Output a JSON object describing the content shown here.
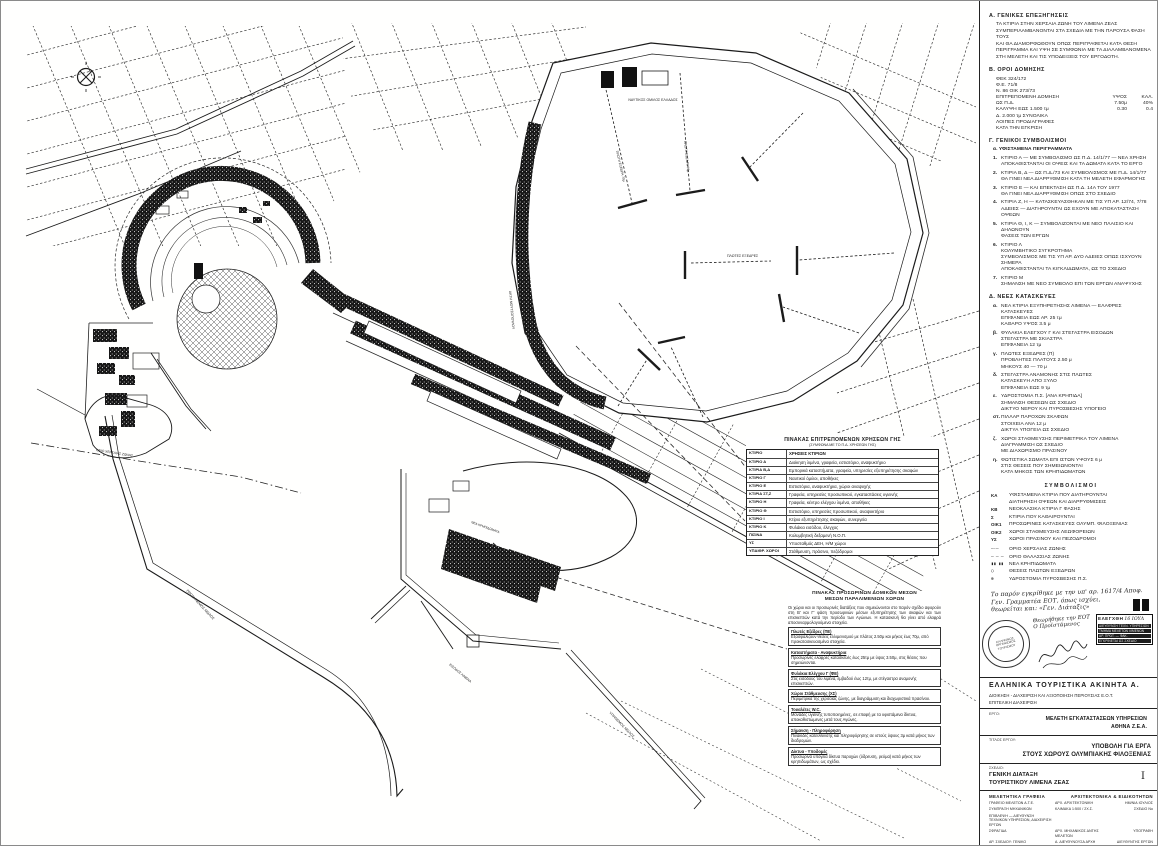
{
  "ink": "#1b1b1b",
  "map": {
    "labels": [
      {
        "text": "ΝΑΥΤΙΚΟΣ ΟΜΙΛΟΣ ΕΛΛΑΔΟΣ"
      },
      {
        "text": "ΠΛΩΤΗ ΕΞΕΔΡΑ 70μ"
      },
      {
        "text": "ΠΛΩΤΗ ΕΞΕΔΡΑ 70μ"
      },
      {
        "text": "ΠΛΩΤΕΣ ΕΞΕΔΡΕΣ"
      },
      {
        "text": "ΑΚΤΗ ΜΟΥΤΣΟΠΟΥΛΟΥ"
      },
      {
        "text": "ΝΕΑ ΚΡΗΠΙΔΩΜΑΤΑ"
      },
      {
        "text": "ΠΡΟΣΗΝΕΜΟΣ ΜΩΛΟΣ"
      },
      {
        "text": "ΥΠΗΝΕΜΟΣ ΜΩΛΟΣ"
      },
      {
        "text": "ΟΡΙΟ ΧΕΡΣΑΙΑΣ ΖΩΝΗΣ"
      },
      {
        "text": "ΕΙΣΟΔΟΣ ΛΙΜΕΝΑ"
      }
    ],
    "tables": {
      "landuse": {
        "title": "ΠΙΝΑΚΑΣ ΕΠΙΤΡΕΠΟΜΕΝΩΝ ΧΡΗΣΕΩΝ ΓΗΣ",
        "subtitle": "(ΣΥΜΦΩΝΑ ΜΕ ΤΟ Π.Δ. ΧΡΗΣΕΩΝ ΓΗΣ)",
        "col1": "ΚΤΙΡΙΟ",
        "col2": "ΧΡΗΣΕΙΣ ΚΤΙΡΙΩΝ",
        "rows": [
          {
            "code": "ΚΤΙΡΙΟ Α",
            "use": "Διοίκηση λιμένα, γραφεία, εστιατόριο, αναψυκτήριο"
          },
          {
            "code": "ΚΤΙΡΙΑ Β,Δ",
            "use": "Εμπορικά καταστήματα, γραφεία, υπηρεσίες εξυπηρέτησης σκαφών"
          },
          {
            "code": "ΚΤΙΡΙΟ Γ",
            "use": "Ναυτικοί όμιλοι, αποθήκες"
          },
          {
            "code": "ΚΤΙΡΙΟ Ε",
            "use": "Εστιατόρια, αναψυκτήρια, χώροι αναψυχής"
          },
          {
            "code": "ΚΤΙΡΙΑ ΣΤ,Ζ",
            "use": "Γραφεία, υπηρεσίες προσωπικού, εγκαταστάσεις υγιεινής"
          },
          {
            "code": "ΚΤΙΡΙΟ Η",
            "use": "Γραφεία, κέντρο ελέγχου λιμένα, αποθήκες"
          },
          {
            "code": "ΚΤΙΡΙΟ Θ",
            "use": "Εστιατόριο, υπηρεσίες προσωπικού, αναψυκτήριο"
          },
          {
            "code": "ΚΤΙΡΙΟ Ι",
            "use": "Κτίριο εξυπηρέτησης σκαφών, συνεργεία"
          },
          {
            "code": "ΚΤΙΡΙΟ Κ",
            "use": "Φυλάκιο εισόδου, έλεγχος"
          },
          {
            "code": "ΠΙΣΙΝΑ",
            "use": "Κολυμβητική δεξαμενή Ν.Ο.Π."
          },
          {
            "code": "ΥΣ",
            "use": "Υποσταθμός ΔΕΗ, Η/Μ χώροι"
          },
          {
            "code": "ΥΠΑΙΘΡ. ΧΩΡΟΙ",
            "use": "Στάθμευση, πράσινο, πεζόδρομοι"
          }
        ]
      },
      "temp": {
        "title1": "ΠΙΝΑΚΑΣ ΠΡΟΣΩΡΙΝΩΝ ΔΟΜΙΚΩΝ ΜΕΣΩΝ",
        "title2": "ΜΕΣΩΝ ΠΑΡΑΛΙΜΕΝΙΩΝ ΧΩΡΩΝ",
        "intro": "Οι χώροι και οι προσωρινές διατάξεις που σημειώνονται στο παρόν σχέδιο αφορούν στη Β' και Γ' φάση προσωρινών μέσων εξυπηρέτησης των σκαφών και των επισκεπτών κατά την περίοδο των Αγώνων. Η κατασκευή θα γίνει από ελαφρά αποσυναρμολογούμενα στοιχεία.",
        "sections": [
          {
            "h": "Πλωτές Εξέδρες (ΠΕ)",
            "b": "Εξασφαλίζουν θέσεις ελλιμενισμού με πλάτος 2.50μ και μήκος έως 70μ, από προκατασκευασμένα στοιχεία."
          },
          {
            "h": "Καταστήματα - Αναψυκτήρια",
            "b": "Προσωρινές ελαφρές κατασκευές έως 25τμ με ύψος 3.50μ, στις θέσεις που σημειώνονται."
          },
          {
            "h": "Φυλάκια Ελέγχου Γ (ΦΕ)",
            "b": "Στις εισόδους του λιμένα, εμβαδού έως 12τμ, με στέγαστρα αναμονής επισκεπτών."
          },
          {
            "h": "Χώροι Στάθμευσης (ΧΣ)",
            "b": "Περιμετρικά της χερσαίας ζώνης, με διαγράμμιση και διαχωριστικά πρασίνου."
          },
          {
            "h": "Τουαλέτες W.C.",
            "b": "Μονάδες υγιεινής τυποποιημένες, σε επαφή με τα υφιστάμενα δίκτυα, αποκαθιστώμενες μετά τους Αγώνες."
          },
          {
            "h": "Σήμανση - Πληροφόρηση",
            "b": "Πινακίδες κατεύθυνσης και πληροφόρησης σε ιστούς ύψους 3μ κατά μήκος των διαδρομών."
          },
          {
            "h": "Δίκτυα - Υποδομές",
            "b": "Προσωρινά υπόγεια δίκτυα παροχών (ύδρευση, ρεύμα) κατά μήκος των κρηπιδωμάτων, ως σχέδιο."
          }
        ]
      }
    }
  },
  "sidebar": {
    "secA": {
      "heading": "Α. ΓΕΝΙΚΕΣ ΕΠΕΞΗΓΗΣΕΙΣ",
      "lines": [
        "ΤΑ ΚΤΙΡΙΑ ΣΤΗΝ ΧΕΡΣΑΙΑ ΖΩΝΗ ΤΟΥ ΛΙΜΕΝΑ ΖΕΑΣ",
        "ΣΥΜΠΕΡΙΛΑΜΒΑΝΟΝΤΑΙ ΣΤΑ ΣΧΕΔΙΑ ΜΕ ΤΗΝ ΠΑΡΟΥΣΑ ΦΑΣΗ ΤΟΥΣ",
        "ΚΑΙ ΘΑ ΔΙΑΜΟΡΦΩΘΟΥΝ ΟΠΩΣ ΠΕΡΙΓΡΑΦΕΤΑΙ ΚΑΤΑ ΘΕΣΗ",
        "ΠΕΡΙΓΡΑΜΜΑ ΚΑΙ ΥΨΗ ΣΕ ΣΥΜΦΩΝΙΑ ΜΕ ΤΑ ΔΙΑΛΑΜΒΑΝΟΜΕΝΑ",
        "ΣΤΗ ΜΕΛΕΤΗ ΚΑΙ ΤΙΣ ΥΠΟΔΕΙΞΕΙΣ ΤΟΥ ΕΡΓΟΔΟΤΗ."
      ]
    },
    "secB": {
      "heading": "Β. ΟΡΟΙ ΔΟΜΗΣΗΣ",
      "rows": [
        {
          "l": "ΦΕΚ 324/172",
          "c1": "",
          "c2": ""
        },
        {
          "l": "Φ.Ε. 71/8",
          "c1": "",
          "c2": ""
        },
        {
          "l": "Ν. 86 ΟΙΚ 273/73",
          "c1": "",
          "c2": ""
        },
        {
          "l": "ΕΠΙΤΡΕΠΟΜΕΝΗ ΔΟΜΗΣΗ",
          "c1": "ΥΨΟΣ",
          "c2": "ΚΑΛ."
        },
        {
          "l": "ΩΣ Π.Δ.",
          "c1": "7.50μ",
          "c2": "40%"
        },
        {
          "l": "ΚΑΛΥΨΗ ΕΩΣ 1.500 τμ",
          "c1": "0.30",
          "c2": "0.4"
        },
        {
          "l": "Δ. 2.000 τμ ΣΥΝΟΛΙΚΑ",
          "c1": "",
          "c2": ""
        },
        {
          "l": "ΛΟΙΠΕΣ ΠΡΟΔΙΑΓΡΑΦΕΣ",
          "c1": "",
          "c2": ""
        },
        {
          "l": "ΚΑΤΑ ΤΗΝ ΕΓΚΡΙΣΗ",
          "c1": "",
          "c2": ""
        }
      ]
    },
    "secC": {
      "heading": "Γ. ΓΕΝΙΚΟΙ ΣΥΜΒΟΛΙΣΜΟΙ",
      "sub": "α. ΥΦΙΣΤΑΜΕΝΑ ΠΕΡΙΓΡΑΜΜΑΤΑ",
      "items": [
        {
          "n": "1.",
          "l1": "ΚΤΙΡΙΟ Α — ΜΕ ΣΥΜΒΟΛΙΣΜΟ ΩΣ Π.Δ. 14/1/77 — ΝΕΑ ΧΡΗΣΗ",
          "l2": "ΑΠΟΚΑΘΙΣΤΑΝΤΑΙ ΟΙ ΟΨΕΙΣ ΚΑΙ ΤΑ ΔΩΜΑΤΑ ΚΑΤΑ ΤΟ ΕΡΓΟ",
          "l3": "",
          "l4": ""
        },
        {
          "n": "2.",
          "l1": "ΚΤΙΡΙΑ Β, Δ — ΩΣ Π.Δ./73 ΚΑΙ ΣΥΜΒΟΛΙΣΜΟΣ ΜΕ Π.Δ. 14/1/77",
          "l2": "ΘΑ ΓΙΝΕΙ ΝΕΑ ΔΙΑΡΡΥΘΜΙΣΗ ΚΑΤΑ ΤΗ ΜΕΛΕΤΗ ΕΦΑΡΜΟΓΗΣ",
          "l3": "",
          "l4": ""
        },
        {
          "n": "3.",
          "l1": "ΚΤΙΡΙΟ Ε — ΚΑΙ ΕΠΕΚΤΑΣΗ ΩΣ Π.Δ. 14Α ΤΟΥ 1977",
          "l2": "ΘΑ ΓΙΝΕΙ ΝΕΑ ΔΙΑΡΡΥΘΜΙΣΗ ΟΠΩΣ ΣΤΟ ΣΧΕΔΙΟ",
          "l3": "",
          "l4": ""
        },
        {
          "n": "4.",
          "l1": "ΚΤΙΡΙΑ Ζ, Η — ΚΑΤΑΣΚΕΥΑΣΘΗΚΑΝ ΜΕ ΤΙΣ ΥΠ ΑΡ. 12/74, 7/78",
          "l2": "ΑΔΕΙΕΣ — ΔΙΑΤΗΡΟΥΝΤΑΙ ΩΣ ΕΧΟΥΝ ΜΕ ΑΠΟΚΑΤΑΣΤΑΣΗ ΟΨΕΩΝ",
          "l3": "",
          "l4": ""
        },
        {
          "n": "5.",
          "l1": "ΚΤΙΡΙΑ Θ, Ι, Κ — ΣΥΜΒΟΛΙΖΟΝΤΑΙ ΜΕ ΝΕΟ ΠΛΑΙΣΙΟ ΚΑΙ ΔΗΛΩΝΟΥΝ",
          "l2": "ΦΑΣΕΙΣ ΤΩΝ ΕΡΓΩΝ",
          "l3": "",
          "l4": ""
        },
        {
          "n": "6.",
          "l1": "ΚΤΙΡΙΟ Λ",
          "l2": "ΚΟΛΥΜΒΗΤΙΚΟ ΣΥΓΚΡΟΤΗΜΑ",
          "l3": "ΣΥΜΒΟΛΙΣΜΟΣ ΜΕ ΤΙΣ ΥΠ ΑΡ. ΔΥΟ ΑΔΕΙΕΣ ΟΠΩΣ ΙΣΧΥΟΥΝ ΣΗΜΕΡΑ",
          "l4": "ΑΠΟΚΑΘΙΣΤΑΝΤΑΙ ΤΑ ΚΙΓΚΛΙΔΩΜΑΤΑ, ΩΣ ΤΟ ΣΧΕΔΙΟ"
        },
        {
          "n": "7.",
          "l1": "ΚΤΙΡΙΟ Μ",
          "l2": "ΣΗΜΑΝΣΗ ΜΕ ΝΕΟ ΣΥΜΒΟΛΟ ΕΠΙ ΤΩΝ ΕΡΓΩΝ ΑΝΑΨΥΧΗΣ",
          "l3": "",
          "l4": ""
        }
      ]
    },
    "secD": {
      "heading": "Δ. ΝΕΕΣ ΚΑΤΑΣΚΕΥΕΣ",
      "items": [
        {
          "n": "α.",
          "l1": "ΝΕΑ ΚΤΙΡΙΑ ΕΞΥΠΗΡΕΤΗΣΗΣ ΛΙΜΕΝΑ — ΕΛΑΦΡΕΣ ΚΑΤΑΣΚΕΥΕΣ",
          "l2": "ΕΠΙΦΑΝΕΙΑ ΕΩΣ ΑΡ. 25 τμ",
          "l3": "ΚΑΘΑΡΟ ΥΨΟΣ 3.5 μ"
        },
        {
          "n": "β.",
          "l1": "ΦΥΛΑΚΙΑ ΕΛΕΓΧΟΥ Γ ΚΑΙ ΣΤΕΓΑΣΤΡΑ ΕΙΣΟΔΩΝ",
          "l2": "ΣΤΕΓΑΣΤΡΑ ΜΕ ΣΚΙΑΣΤΡΑ",
          "l3": "ΕΠΙΦΑΝΕΙΑ 12 τμ"
        },
        {
          "n": "γ.",
          "l1": "ΠΛΩΤΕΣ ΕΞΕΔΡΕΣ (Π)",
          "l2": "ΠΡΟΒΛΗΤΕΣ ΠΛΑΤΟΥΣ 2.50 μ",
          "l3": "ΜΗΚΟΥΣ 40 — 70 μ"
        },
        {
          "n": "δ.",
          "l1": "ΣΤΕΓΑΣΤΡΑ ΑΝΑΜΟΝΗΣ ΣΤΙΣ ΠΛΩΤΕΣ",
          "l2": "ΚΑΤΑΣΚΕΥΗ ΑΠΟ ΞΥΛΟ",
          "l3": "ΕΠΙΦΑΝΕΙΑ ΕΩΣ 9 τμ"
        },
        {
          "n": "ε.",
          "l1": "ΥΔΡΟΣΤΟΜΙΑ Π.Σ. [ΑΝΑ ΚΡΗΠΙΔΑ]",
          "l2": "ΣΗΜΑΝΣΗ ΘΕΣΕΩΝ ΩΣ ΣΧΕΔΙΟ",
          "l3": "ΔΙΚΤΥΟ ΝΕΡΟΥ ΚΑΙ ΠΥΡΟΣΒΕΣΗΣ ΥΠΟΓΕΙΟ"
        },
        {
          "n": "στ.",
          "l1": "ΠΙΛΛΑΡ ΠΑΡΟΧΩΝ ΣΚΑΦΩΝ",
          "l2": "ΣΤΟΙΧΕΙΑ ΑΝΑ 12 μ",
          "l3": "ΔΙΚΤΥΑ ΥΠΟΓΕΙΑ ΩΣ ΣΧΕΔΙΟ"
        },
        {
          "n": "ζ.",
          "l1": "ΧΩΡΟΙ ΣΤΑΘΜΕΥΣΗΣ ΠΕΡΙΜΕΤΡΙΚΑ ΤΟΥ ΛΙΜΕΝΑ",
          "l2": "ΔΙΑΓΡΑΜΜΙΣΗ ΩΣ ΣΧΕΔΙΟ",
          "l3": "ΜΕ ΔΙΑΧΩΡΙΣΜΟ ΠΡΑΣΙΝΟΥ"
        },
        {
          "n": "η.",
          "l1": "ΦΩΤΙΣΤΙΚΑ ΣΩΜΑΤΑ ΕΠΙ ΙΣΤΩΝ ΥΨΟΥΣ 6 μ",
          "l2": "ΣΤΙΣ ΘΕΣΕΙΣ ΠΟΥ ΣΗΜΕΙΩΝΟΝΤΑΙ",
          "l3": "ΚΑΤΑ ΜΗΚΟΣ ΤΩΝ ΚΡΗΠΙΔΩΜΑΤΩΝ"
        }
      ]
    },
    "legend": {
      "heading": "ΣΥΜΒΟΛΙΣΜΟΙ",
      "codes": [
        {
          "sym": "ΚΑ",
          "text": "ΥΦΙΣΤΑΜΕΝΑ ΚΤΙΡΙΑ ΠΟΥ ΔΙΑΤΗΡΟΥΝΤΑΙ"
        },
        {
          "sym": "",
          "text": "ΔΙΑΤΗΡΗΣΗ ΟΨΕΩΝ ΚΑΙ ΔΙΑΡΡΥΘΜΙΣΕΙΣ"
        },
        {
          "sym": "ΚΒ",
          "text": "ΝΕΟΚΛΑΣΙΚΑ ΚΤΙΡΙΑ Γ ΦΑΣΗΣ"
        },
        {
          "sym": "Σ",
          "text": "ΚΤΙΡΙΑ ΠΟΥ ΚΑΘΑΙΡΟΥΝΤΑΙ"
        },
        {
          "sym": "ΟΙΚ1",
          "text": "ΠΡΟΣΩΡΙΝΕΣ ΚΑΤΑΣΚΕΥΕΣ ΟΛΥΜΠ. ΦΙΛΟΞΕΝΙΑΣ"
        },
        {
          "sym": "ΟΙΚ2",
          "text": "ΧΩΡΟΙ ΣΤΑΘΜΕΥΣΗΣ ΛΕΩΦΟΡΕΙΩΝ"
        },
        {
          "sym": "ΥΣ",
          "text": "ΧΩΡΟΙ ΠΡΑΣΙΝΟΥ ΚΑΙ ΠΕΖΟΔΡΟΜΟΙ"
        }
      ],
      "lines": [
        {
          "sym": "—·—",
          "text": "ΟΡΙΟ ΧΕΡΣΑΙΑΣ ΖΩΝΗΣ"
        },
        {
          "sym": "– – –",
          "text": "ΟΡΙΟ ΘΑΛΑΣΣΙΑΣ ΖΩΝΗΣ"
        },
        {
          "sym": "▮▮ ▮▮",
          "text": "ΝΕΑ ΚΡΗΠΙΔΩΜΑΤΑ"
        },
        {
          "sym": "○",
          "text": "ΘΕΣΕΙΣ ΠΛΩΤΩΝ ΕΞΕΔΡΩΝ"
        },
        {
          "sym": "⊕",
          "text": "ΥΔΡΟΣΤΟΜΙΑ ΠΥΡΟΣΒΕΣΗΣ Π.Σ."
        }
      ]
    },
    "note": {
      "lines": [
        "Το παρόν εγκρίθηκε με την υπ' αρ. 1617/4 Αποφ.",
        "Γεν. Γραμματέα ΕΟΤ, όπως ισχύει,",
        "θεωρείται και: «Γεν. Διάταξις»"
      ]
    },
    "stamps": {
      "round_text": "ΕΛΛΗΝΙΚΟΣ ΟΡΓΑΝΙΣΜΟΣ ΤΟΥΡΙΣΜΟΥ",
      "hand1": "Θεωρήθηκε την ΕΟΤ",
      "hand2": "Ο Προϊστάμενος",
      "rect_title": "ΕΛΕΓΧΘΗ",
      "rect_date": "16 ΙΟΥΛ",
      "rect_rows": [
        "ΔΙΕΥΘΥΝΣΗ ΤΕΧΝ. ΥΠΗΡΕΣΙΩΝ",
        "ΤΜΗΜΑ ΜΕΛΕΤΩΝ ΛΙΜΕΝΩΝ",
        "ΑΡ. ΠΡΩΤ. — ΦΑΚ.",
        "ΕΓΚΡΙΝΕΤΑΙ ΩΣ ΣΧΕΔΙΟ"
      ]
    },
    "titleblock": {
      "company": "ΕΛΛΗΝΙΚΑ ΤΟΥΡΙΣΤΙΚΑ ΑΚΙΝΗΤΑ Α.",
      "sub1": "ΔΙΟΙΚΗΣΗ - ΔΙΑΧΕΙΡΙΣΗ ΚΑΙ ΑΞΙΟΠΟΙΗΣΗ ΠΕΡΙΟΥΣΙΑΣ Ε.Ο.Τ.",
      "sub2": "ΕΠΙΤΕΛΙΚΗ ΔΙΑΧΕΙΡΙΣΗ",
      "erg_label": "ΕΡΓΟ:",
      "meleti1": "ΜΕΛΕΤΗ ΕΓΚΑΤΑΣΤΑΣΕΩΝ ΥΠΗΡΕΣΙΩΝ",
      "meleti2": "ΑΘΗΝΑ   Ζ.Ε.Α.",
      "title_label": "ΤΙΤΛΟΣ ΕΡΓΟΥ:",
      "project1": "ΥΠΟΒΟΛΗ ΓΙΑ ΕΡΓΑ",
      "project2": "ΣΤΟΥΣ ΧΩΡΟΥΣ ΟΛΥΜΠΙΑΚΗΣ ΦΙΛΟΞΕΝΙΑΣ",
      "sxedio_label": "ΣΧΕΔΙΟ:",
      "page_num": "Ι",
      "drawing1": "ΓΕΝΙΚΗ ΔΙΑΤΑΞΗ",
      "drawing2": "ΤΟΥΡΙΣΤΙΚΟΥ ΛΙΜΕΝΑ ΖΕΑΣ",
      "firms_h1": "ΜΕΛΕΤΗΤΙΚΑ ΓΡΑΦΕΙΑ",
      "firms_h2": "ΑΡΧΙΤΕΚΤΟΝΙΚΑ & ΕΙΔΙΚΟΤΗΤΩΝ",
      "firm_rows": [
        {
          "c1": "ΓΡΑΦΕΙΟ ΜΕΛΕΤΩΝ Α.Τ.Ε.",
          "c2": "ΑΡΧ. ΑΡΧΙΤΕΚΤΟΝΙΚΗ",
          "c3": "ΗΜ/ΝΙΑ ΙΟΥΛΙΟΣ"
        },
        {
          "c1": "ΣΥΜΠΡΑΞΗ ΜΗΧΑΝΙΚΩΝ",
          "c2": "ΚΛΙΜΑΚΑ 1:500 / 2Χ.Σ.",
          "c3": "ΣΧΕΔΙΟ Νο"
        },
        {
          "c1": "ΕΠΙΒΛΕΨΗ — ΔΙΕΥΘΥΝΣΗ ΤΕΧΝΙΚΩΝ ΥΠΗΡΕΣΙΩΝ, ΔΙΑΧΕΙΡΙΣΗ ΕΡΓΩΝ",
          "c2": "",
          "c3": ""
        },
        {
          "c1": "ΣΦΡΑΓΙΔΑ",
          "c2": "ΑΡΧ. ΜΗΧΑΝΙΚΟΣ ΔΝΤΗΣ ΜΕΛΕΤΩΝ",
          "c3": "ΥΠΟΓΡΑΦΗ"
        },
        {
          "c1": "ΑΡ. ΣΧΕΔΙΟΥ: ΓΕΝΙΚΟ",
          "c2": "Α. ΔΙΕΥΘΥΝΟΥΣΑ ΑΡΧΗ",
          "c3": "ΔΙΕΥΘΥΝΤΗΣ ΕΡΓΩΝ"
        }
      ]
    }
  }
}
